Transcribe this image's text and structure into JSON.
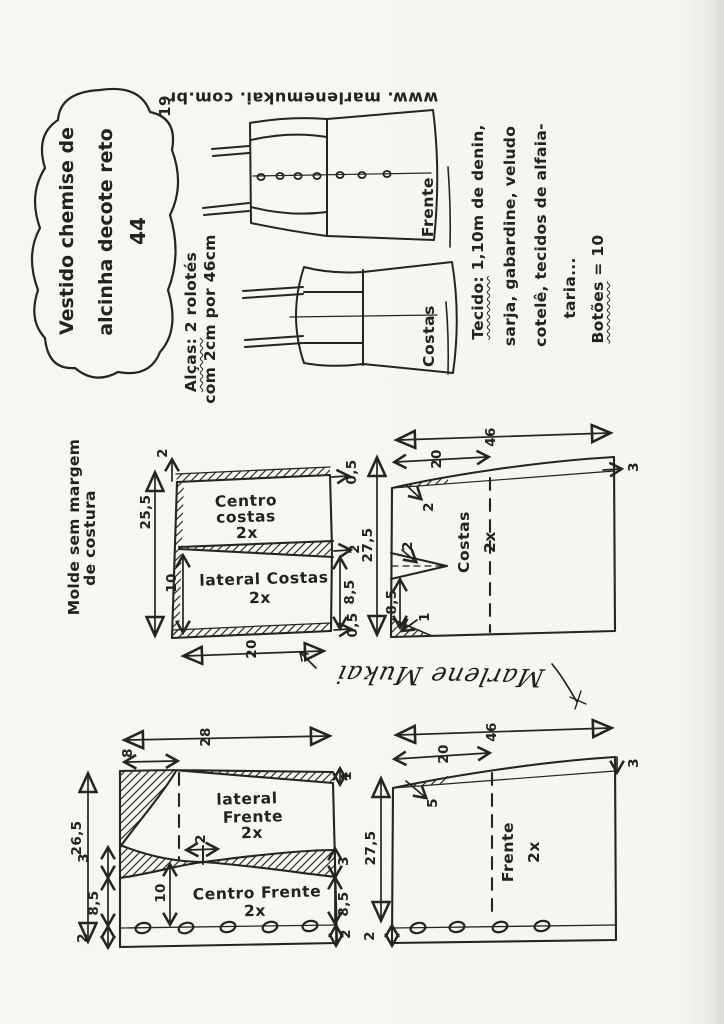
{
  "page": {
    "number": "19",
    "website": "www. marlenemukai. com.br",
    "signature": "Marlene Mukai"
  },
  "title_cloud": {
    "line1": "Vestido chemise de",
    "line2": "alcinha decote reto",
    "line3": "44"
  },
  "notes": {
    "molde_line1": "Molde sem margem",
    "molde_line2": "de costura",
    "alcas_head": "Alças:",
    "alcas_rest": " 2 rolotés",
    "alcas_line2": "com 2cm por 46cm",
    "tecido_head": "Tecido:",
    "tecido_rest": " 1,10m de denin,",
    "tecido_line2": "sarja, gabardine, veludo",
    "tecido_line3": "cotelê, tecidos de alfaia-",
    "tecido_line4": "taria...",
    "botoes_head": "Botões",
    "botoes_rest": " = 10"
  },
  "sketch": {
    "front_label": "Frente",
    "back_label": "Costas"
  },
  "back_panels": {
    "name1_line1": "Centro",
    "name1_line2": "costas",
    "name1_qty": "2x",
    "name2": "lateral Costas",
    "name2_qty": "2x",
    "m_top_2": "2",
    "m_height": "25,5",
    "m_right_top": "0,5",
    "m_right_mid": "2",
    "m_right_85": "8,5",
    "m_right_bottom": "0,5",
    "m_inner_10": "10",
    "m_bottom_20": "20"
  },
  "back_piece": {
    "name": "Costas",
    "qty": "2x",
    "m_width": "46",
    "m_partial": "20",
    "m_side_3": "3",
    "m_height": "27,5",
    "m_shoulder_2": "2",
    "m_dart_2": "2",
    "m_85": "8,5",
    "m_1": "1"
  },
  "front_panels": {
    "name1_line1": "lateral",
    "name1_line2": "Frente",
    "name1_qty": "2x",
    "name2": "Centro Frente",
    "name2_qty": "2x",
    "m_width": "28",
    "m_partial_8": "8",
    "m_height": "26,5",
    "m_left_3": "3",
    "m_left_85": "8,5",
    "m_left_2": "2",
    "m_inner_10": "10",
    "m_dart_2": "2",
    "m_right_1": "1",
    "m_right_3": "3",
    "m_right_85": "8,5",
    "m_right_2": "2"
  },
  "front_piece": {
    "name": "Frente",
    "qty": "2x",
    "m_width": "46",
    "m_partial": "20",
    "m_side_3": "3",
    "m_height": "27,5",
    "m_shoulder_5": "5",
    "m_bottom_2": "2"
  }
}
